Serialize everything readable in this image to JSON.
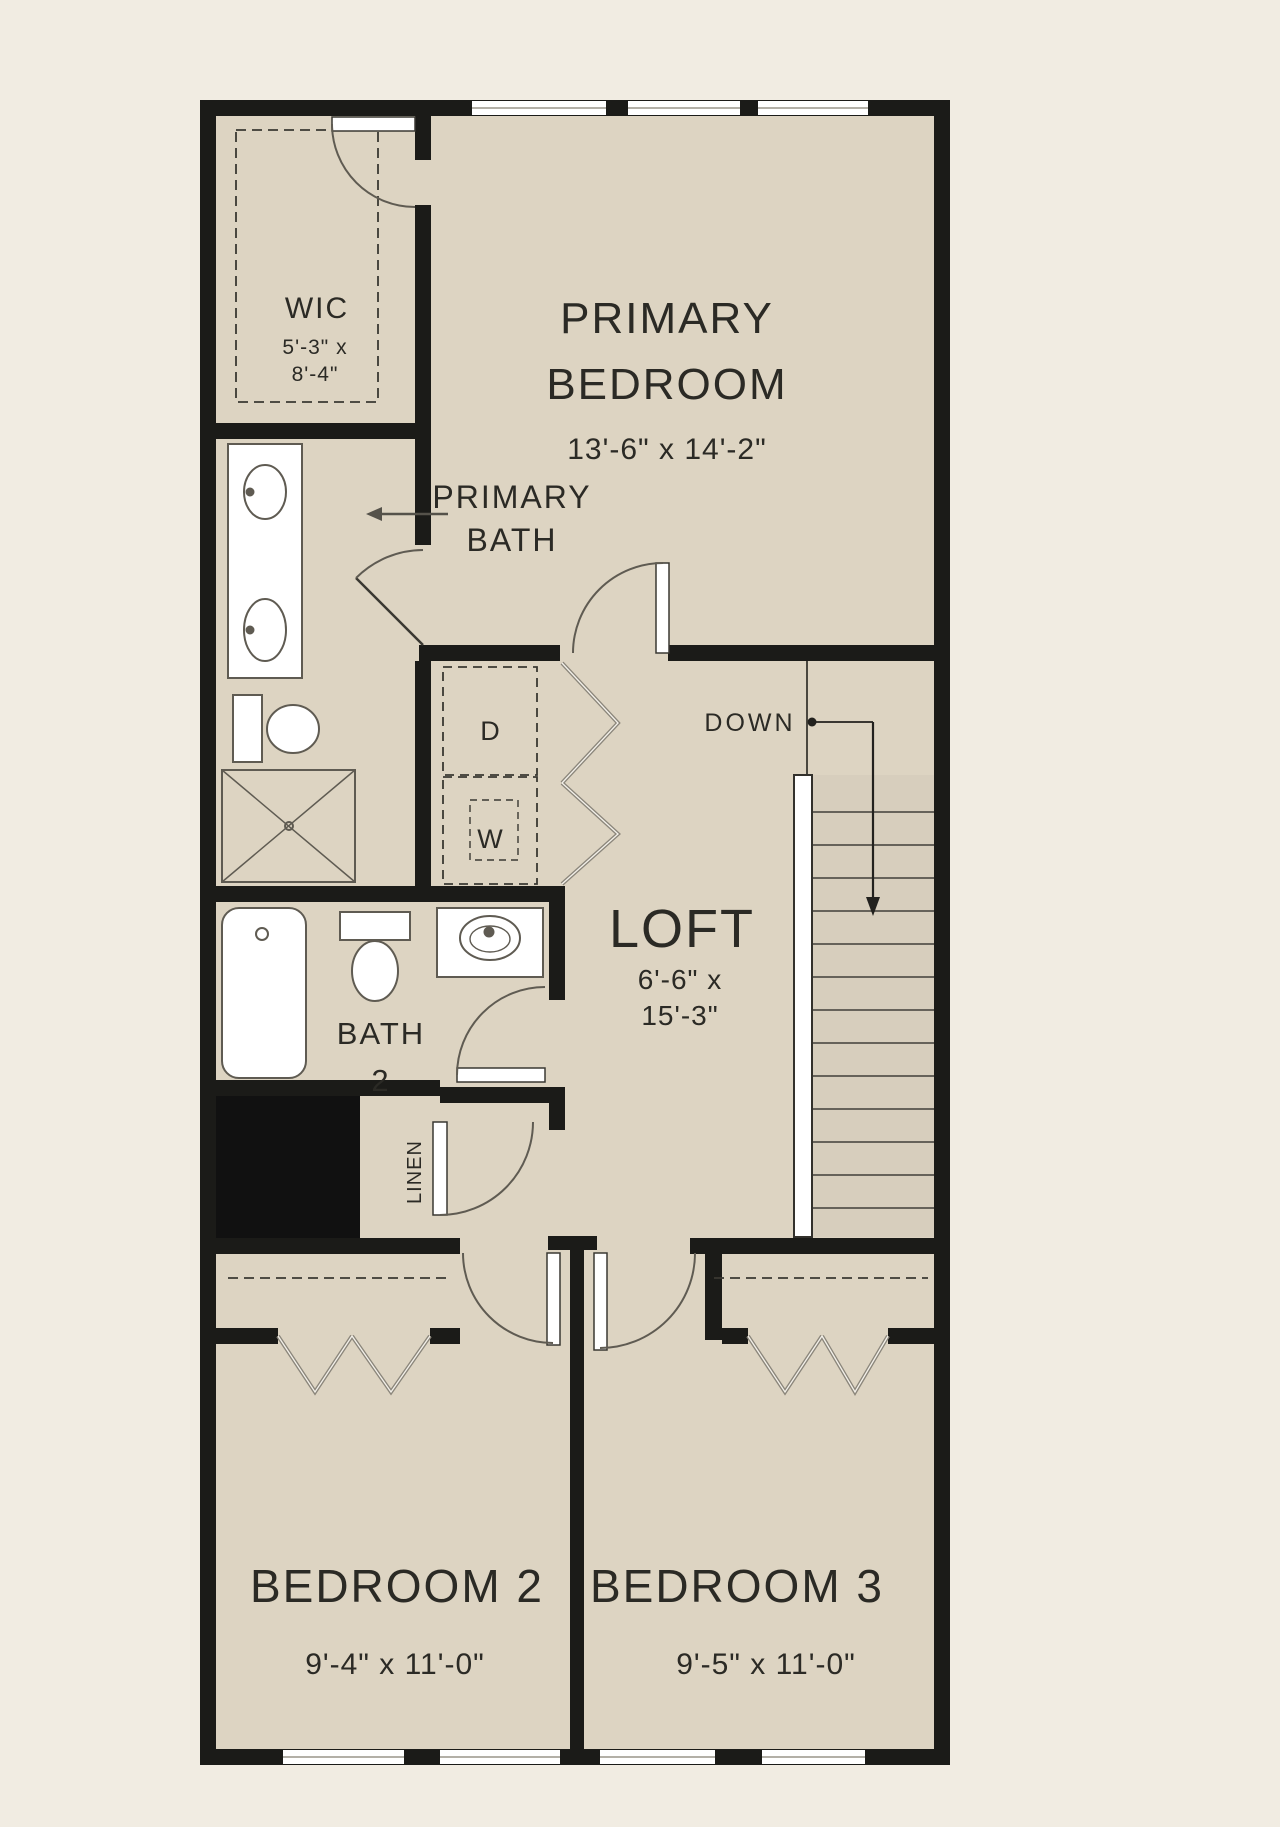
{
  "plan": {
    "type": "floor-plan",
    "floor": "second-floor",
    "colors": {
      "page_background": "#f1ece2",
      "room_fill": "#ddd4c2",
      "wall": "#1b1b18",
      "fixture_line": "#5f5b52",
      "stair_fill": "#d7cebd",
      "white": "#ffffff"
    },
    "rooms": {
      "wic": {
        "name": "WIC",
        "dim_line1": "5'-3\" x",
        "dim_line2": "8'-4\""
      },
      "primary_bedroom": {
        "name_line1": "PRIMARY",
        "name_line2": "BEDROOM",
        "dims": "13'-6\" x 14'-2\""
      },
      "primary_bath": {
        "name_line1": "PRIMARY",
        "name_line2": "BATH"
      },
      "loft": {
        "name": "LOFT",
        "dim_line1": "6'-6\" x",
        "dim_line2": "15'-3\""
      },
      "bath2": {
        "name_line1": "BATH",
        "name_line2": "2"
      },
      "linen": {
        "name": "LINEN"
      },
      "bedroom2": {
        "name": "BEDROOM 2",
        "dims": "9'-4\" x 11'-0\""
      },
      "bedroom3": {
        "name": "BEDROOM 3",
        "dims": "9'-5\" x 11'-0\""
      }
    },
    "labels": {
      "down": "DOWN",
      "dryer": "D",
      "washer": "W"
    }
  }
}
